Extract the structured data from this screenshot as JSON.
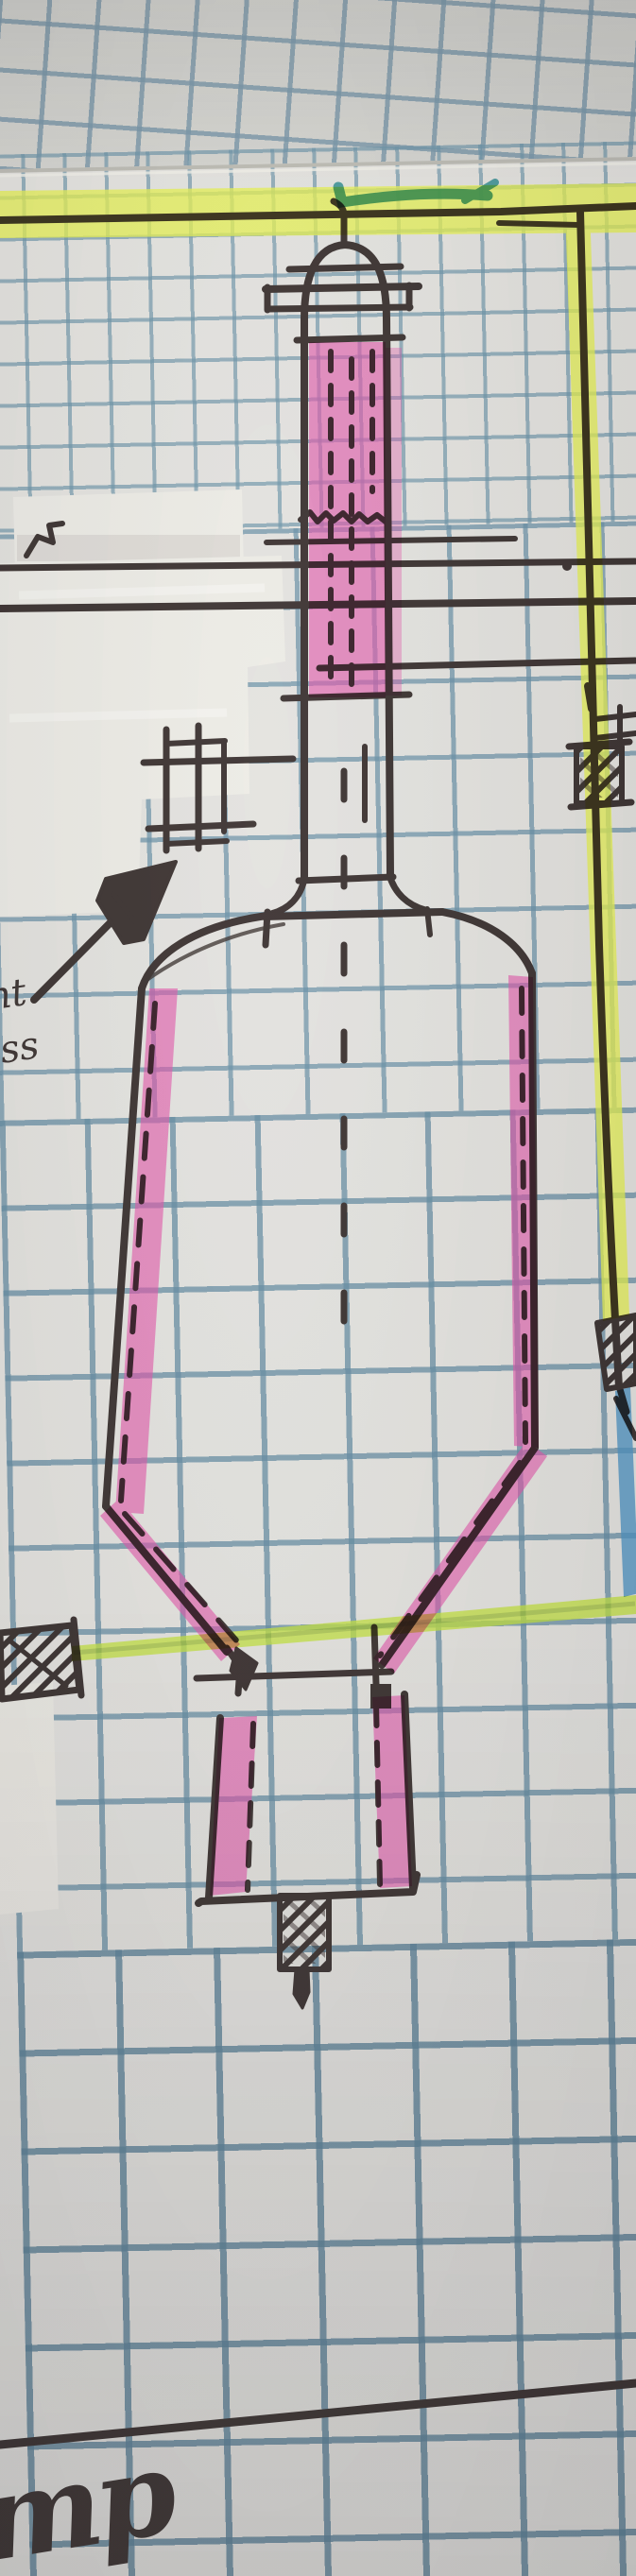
{
  "photo": {
    "subject": "Hand-drawn process equipment sketch: vertical vessel with domed flanged top nozzle, pink-highlighted column and walls, conical bottom, outlet box and hatched valves, drawn in ink on blue graph paper",
    "media": [
      "black ink pen",
      "pink highlighter",
      "yellow highlighter",
      "yellow-green highlighter",
      "teal marker",
      "blue marker",
      "correction tape"
    ]
  },
  "labels": {
    "left_note_line1": "nt",
    "left_note_line2": "ss",
    "corner_scribble": "mp"
  },
  "colors": {
    "paper": "#e4e3df",
    "paper_behind": "#d5d5d0",
    "grid_blue": "#6e94ac",
    "ink": "#3b3230",
    "highlighter_pink": "#e24fa8",
    "highlighter_yellow": "#e7f24f",
    "highlighter_yellow_green": "#c3e23c",
    "marker_teal": "#2f8b90",
    "marker_blue": "#4e93c2",
    "correction_tape": "#edece6"
  },
  "components": [
    "domed top nozzle with flange lines",
    "upper column with pink highlighted sections and dashed internals",
    "wavy break line across column",
    "horizontal piping tie-ins at left over correction tape",
    "small flange-instrument cluster",
    "up-right arrow annotation from note",
    "main vessel shell, pink highlighted walls, dashed centerline",
    "conical bottom with pink highlighted slopes",
    "bottom outlet box with pink highlighted walls",
    "cross-hatched valves: left line, right border line, lower right edge, bottom nozzle",
    "yellow highlighted border and bottom line",
    "teal check stroke on top border",
    "blue marker diagonal at right edge",
    "pen line and scribble at bottom corner"
  ]
}
